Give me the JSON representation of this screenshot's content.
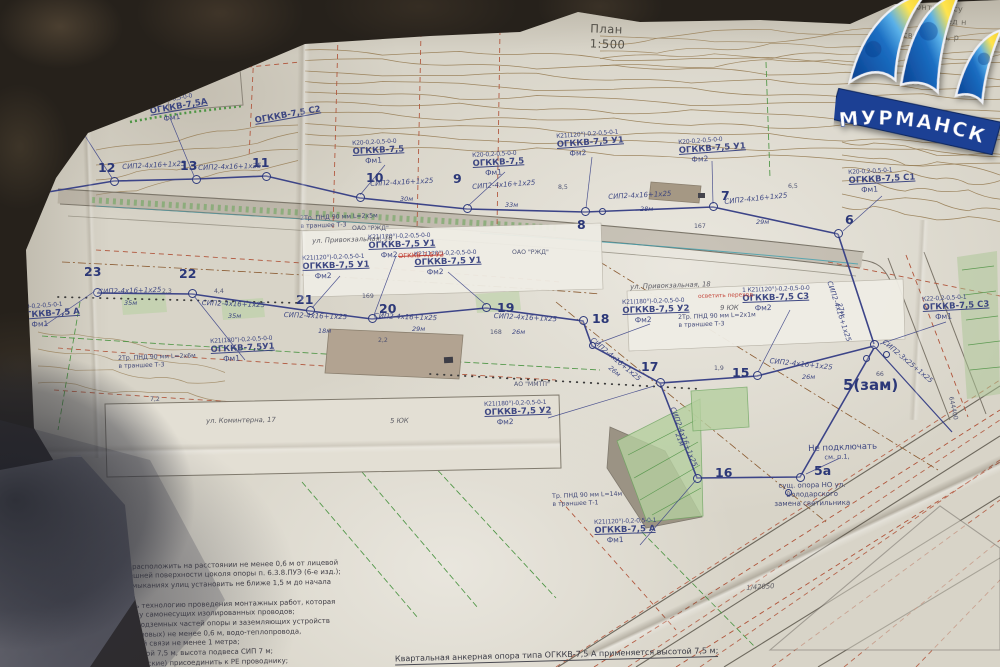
{
  "meta": {
    "title": "План",
    "scale": "1:500"
  },
  "logo": {
    "city": "МУРМАНСК"
  },
  "footer": {
    "line1": "Квартальная анкерная опора типа ОГККВ-7,5 А применяется высотой 7,5 м;",
    "line2": "12, 14, 16, 23;"
  },
  "notes": [
    "1.Опоры наружного освещения расположить на расстоянии не менее 0,6 м от лицевой грани бортового камня до внешней поверхности цоколя опоры п. 6.3.8.ПУЭ (6-е изд.);",
    "2.Опоры на пересечениях и примыканиях улиц установить не ближе 1,5 м до начала закругления тротуаров;",
    "3.При монтаже строго соблюдать технологию проведения монтажных работ, которая обеспечит правильную подвеску самонесущих изолированных проводов;",
    "4.Расстояние по горизонтали от подземных частей опоры и заземляющих устройств опор до подземных кабелей (силовых) не менее 0,6 м, водо-теплопровода, канализационных труб и кабелей связи не менее 1 метра;",
    "5.Опора ОГККВ применяется высотой 7,5 м, высота подвеса СИП 7 м;",
    "6.Опоры и конструкции (металлические) присоединить к РЕ проводнику;"
  ],
  "plan": {
    "poles": [
      {
        "n": "12",
        "cx": 114,
        "cy": 181,
        "nx": 98,
        "ny": 160
      },
      {
        "n": "13",
        "cx": 196,
        "cy": 179,
        "nx": 180,
        "ny": 158
      },
      {
        "n": "11",
        "cx": 266,
        "cy": 176,
        "nx": 252,
        "ny": 155
      },
      {
        "n": "10",
        "cx": 360,
        "cy": 197,
        "nx": 366,
        "ny": 170
      },
      {
        "n": "9",
        "cx": 467,
        "cy": 208,
        "nx": 453,
        "ny": 171
      },
      {
        "n": "8",
        "cx": 585,
        "cy": 211,
        "nx": 577,
        "ny": 217
      },
      {
        "n": "7",
        "cx": 713,
        "cy": 206,
        "nx": 721,
        "ny": 188
      },
      {
        "n": "6",
        "cx": 838,
        "cy": 233,
        "nx": 845,
        "ny": 212
      },
      {
        "n": "23",
        "cx": 97,
        "cy": 292,
        "nx": 84,
        "ny": 264
      },
      {
        "n": "22",
        "cx": 192,
        "cy": 293,
        "nx": 179,
        "ny": 266
      },
      {
        "n": "21",
        "cx": 310,
        "cy": 310,
        "nx": 296,
        "ny": 292
      },
      {
        "n": "20",
        "cx": 372,
        "cy": 318,
        "nx": 379,
        "ny": 301
      },
      {
        "n": "19",
        "cx": 486,
        "cy": 307,
        "nx": 497,
        "ny": 300
      },
      {
        "n": "18",
        "cx": 583,
        "cy": 320,
        "nx": 592,
        "ny": 311
      },
      {
        "n": "17",
        "cx": 660,
        "cy": 382,
        "nx": 641,
        "ny": 359
      },
      {
        "n": "15",
        "cx": 757,
        "cy": 375,
        "nx": 732,
        "ny": 365
      },
      {
        "n": "16",
        "cx": 697,
        "cy": 478,
        "nx": 715,
        "ny": 465
      },
      {
        "n": "5а",
        "cx": 800,
        "cy": 477,
        "nx": 814,
        "ny": 463
      },
      {
        "n": "5(зам)",
        "cx": 874,
        "cy": 344,
        "nx": 843,
        "ny": 376,
        "big": true
      }
    ],
    "extra_rings": [
      [
        602,
        211
      ],
      [
        592,
        345
      ],
      [
        886,
        354
      ],
      [
        866,
        358
      ],
      [
        788,
        492
      ]
    ],
    "labels": [
      {
        "k": "spec",
        "x": 352,
        "y": 140,
        "r": -3,
        "c": "К20-0,2-0,5-0-0",
        "n": "ОГККВ-7,5",
        "p": "Фм1"
      },
      {
        "k": "spec",
        "x": 472,
        "y": 152,
        "r": -3,
        "c": "К20-0,2-0,5-0-0",
        "n": "ОГККВ-7,5",
        "p": "Фм1"
      },
      {
        "k": "spec",
        "x": 556,
        "y": 133,
        "r": -4,
        "c": "К21(120°)-0,2-0,5-0-1",
        "n": "ОГККВ-7,5 У1",
        "p": "Фм2"
      },
      {
        "k": "spec",
        "x": 678,
        "y": 139,
        "r": -4,
        "c": "К20-0,2-0,5-0-0",
        "n": "ОГККВ-7,5 У1",
        "p": "Фм2"
      },
      {
        "k": "spec",
        "x": 848,
        "y": 169,
        "r": -3,
        "c": "К20-0,2-0,5-0-1",
        "n": "ОГККВ-7,5 С1",
        "p": "Фм1"
      },
      {
        "k": "spec",
        "x": 368,
        "y": 234,
        "r": -2,
        "c": "К21(120°)-0,2-0,5-0-0",
        "n": "ОГККВ-7,5 У1",
        "p": "Фм2"
      },
      {
        "k": "spec",
        "x": 302,
        "y": 255,
        "r": -2,
        "c": "К21(120°)-0,2-0,5-0-1",
        "n": "ОГККВ-7,5 У1",
        "p": "Фм2"
      },
      {
        "k": "spec",
        "x": 414,
        "y": 251,
        "r": -2,
        "c": "К21(120°)-0,2-0,5-0-0",
        "n": "ОГККВ-7,5 У1",
        "p": "Фм2"
      },
      {
        "k": "spec",
        "x": 622,
        "y": 299,
        "r": -2,
        "c": "К21(180°)-0,2-0,5-0-0",
        "n": "ОГККВ-7,5 У2",
        "p": "Фм2"
      },
      {
        "k": "spec",
        "x": 742,
        "y": 287,
        "r": -2,
        "c": "1 К21(120°)-0,2-0,5-0-0",
        "n": "ОГККВ-7,5 С3",
        "p": "Фм2"
      },
      {
        "k": "spec",
        "x": 484,
        "y": 401,
        "r": -2,
        "c": "К21(180°)-0,2-0,5-0-1",
        "n": "ОГККВ-7,5 У2",
        "p": "Фм2"
      },
      {
        "k": "spec",
        "x": 594,
        "y": 519,
        "r": -2,
        "c": "К21(120°)-0,2-0,5-0-1",
        "n": "ОГККВ-7,5 А",
        "p": "Фм1"
      },
      {
        "k": "spec",
        "x": 922,
        "y": 296,
        "r": -3,
        "c": "К22-0,2-0,5-0-1",
        "n": "ОГККВ-7,5 С3",
        "p": "Фм1"
      },
      {
        "k": "spec",
        "x": 18,
        "y": 304,
        "r": -4,
        "c": "К20-0,2-0,5-0-1",
        "n": "ОГККВ-7,5 А",
        "p": "Фм1"
      },
      {
        "k": "spec",
        "x": 210,
        "y": 338,
        "r": -3,
        "c": "К21(180°)-0,2-0,5-0-0",
        "n": "ОГККВ-7,5У1",
        "p": "Фм1"
      },
      {
        "k": "spec",
        "x": 64,
        "y": 110,
        "r": -9,
        "c": "К20-0,2-0,5-0-1",
        "n": "ОГККВ-7,5А",
        "p": "Фм1"
      },
      {
        "k": "spec",
        "x": 148,
        "y": 100,
        "r": -10,
        "c": "К20-0,2-0,5-0-0",
        "n": "ОГККВ-7,5А",
        "p": "Фм1"
      },
      {
        "k": "spec",
        "x": 254,
        "y": 116,
        "r": -10,
        "c": "",
        "n": "ОГККВ-7,5 С2",
        "p": ""
      },
      {
        "k": "wire",
        "x": 370,
        "y": 180,
        "r": -3,
        "t": "СИП2-4х16+1х25"
      },
      {
        "k": "wire",
        "x": 472,
        "y": 183,
        "r": -4,
        "t": "СИП2-4х16+1х25"
      },
      {
        "k": "wire",
        "x": 608,
        "y": 193,
        "r": -3,
        "t": "СИП2-4х16+1х25"
      },
      {
        "k": "wire",
        "x": 724,
        "y": 198,
        "r": -6,
        "t": "СИП2-4х16+1х25"
      },
      {
        "k": "wire",
        "x": 98,
        "y": 288,
        "r": -2,
        "t": "СИП2-4х16+1х25"
      },
      {
        "k": "wire",
        "x": 202,
        "y": 299,
        "r": 2,
        "t": "СИП2-4х16+1х25"
      },
      {
        "k": "wire",
        "x": 284,
        "y": 311,
        "r": 2,
        "t": "СИП2-4х16+1х25"
      },
      {
        "k": "wire",
        "x": 374,
        "y": 312,
        "r": 2,
        "t": "СИП2-4х16+1х25"
      },
      {
        "k": "wire",
        "x": 494,
        "y": 312,
        "r": 3,
        "t": "СИП2-4х16+1х25"
      },
      {
        "k": "wire",
        "x": 594,
        "y": 336,
        "r": 40,
        "t": "СИП2-4х16+1х25"
      },
      {
        "k": "wire",
        "x": 770,
        "y": 357,
        "r": 6,
        "t": "СИП2-4х16+1х25"
      },
      {
        "k": "wire",
        "x": 676,
        "y": 406,
        "r": 69,
        "t": "СИП2-4х16+1х25"
      },
      {
        "k": "wire",
        "x": 886,
        "y": 338,
        "r": 40,
        "t": "СИП2-3х25+1х25"
      },
      {
        "k": "wire",
        "x": 833,
        "y": 280,
        "r": 72,
        "t": "СИП2-4х16+1х25"
      },
      {
        "k": "wire",
        "x": 122,
        "y": 163,
        "r": -3,
        "t": "СИП2-4х16+1х25"
      },
      {
        "k": "wire",
        "x": 198,
        "y": 164,
        "r": -2,
        "t": "СИП2-4х16+1х25"
      },
      {
        "k": "len",
        "x": 400,
        "y": 195,
        "t": "30м"
      },
      {
        "k": "len",
        "x": 505,
        "y": 201,
        "t": "33м"
      },
      {
        "k": "len",
        "x": 640,
        "y": 205,
        "t": "28м"
      },
      {
        "k": "len",
        "x": 756,
        "y": 218,
        "t": "29м"
      },
      {
        "k": "len",
        "x": 124,
        "y": 299,
        "t": "35м"
      },
      {
        "k": "len",
        "x": 228,
        "y": 312,
        "t": "35м"
      },
      {
        "k": "len",
        "x": 318,
        "y": 327,
        "t": "18м"
      },
      {
        "k": "len",
        "x": 412,
        "y": 325,
        "t": "29м"
      },
      {
        "k": "len",
        "x": 512,
        "y": 328,
        "t": "26м"
      },
      {
        "k": "len",
        "x": 612,
        "y": 364,
        "r": 40,
        "t": "26м"
      },
      {
        "k": "len",
        "x": 802,
        "y": 373,
        "t": "26м"
      },
      {
        "k": "len",
        "x": 681,
        "y": 432,
        "r": 69,
        "t": "21м"
      },
      {
        "k": "len",
        "x": 843,
        "y": 302,
        "r": 72,
        "t": "27м"
      },
      {
        "k": "trench",
        "x": 300,
        "y": 215,
        "r": -2,
        "a": "2Тр. ПНД 90 мм L=2х5м",
        "b": "в траншее Т-3"
      },
      {
        "k": "trench",
        "x": 678,
        "y": 314,
        "r": -2,
        "a": "2Тр. ПНД 90 мм L=2х1м",
        "b": "в траншее Т-3"
      },
      {
        "k": "trench",
        "x": 118,
        "y": 355,
        "r": -2,
        "a": "2Тр. ПНД 90 мм L=2х6м",
        "b": "в траншее Т-3"
      },
      {
        "k": "trench",
        "x": 552,
        "y": 493,
        "r": -2,
        "a": "Тр. ПНД 90 мм L=14м",
        "b": "в траншее Т-1"
      },
      {
        "k": "place",
        "x": 312,
        "y": 237,
        "r": -2,
        "t": "ул. Привокзальная, 16"
      },
      {
        "k": "place",
        "x": 630,
        "y": 283,
        "r": -2,
        "t": "ул. Привокзальная, 18"
      },
      {
        "k": "place",
        "x": 206,
        "y": 417,
        "r": -1,
        "t": "ул. Коминтерна, 17"
      },
      {
        "k": "place",
        "x": 390,
        "y": 417,
        "r": -1,
        "t": "5 ЮК"
      },
      {
        "k": "place",
        "x": 720,
        "y": 304,
        "r": -1,
        "t": "9 ЮК"
      },
      {
        "k": "place",
        "x": 746,
        "y": 584,
        "r": -4,
        "t": "1/42050"
      },
      {
        "k": "tiny",
        "x": 352,
        "y": 225,
        "t": "ОАО \"РЖД\""
      },
      {
        "k": "tiny",
        "x": 512,
        "y": 249,
        "t": "ОАО \"РЖД\""
      },
      {
        "k": "tiny",
        "x": 514,
        "y": 381,
        "t": "АО \"ММТП\""
      },
      {
        "k": "tiny",
        "x": 954,
        "y": 396,
        "r": 78,
        "t": "644400"
      },
      {
        "k": "tiny",
        "x": 362,
        "y": 293,
        "t": "169"
      },
      {
        "k": "tiny",
        "x": 490,
        "y": 329,
        "t": "168"
      },
      {
        "k": "tiny",
        "x": 694,
        "y": 223,
        "t": "167"
      },
      {
        "k": "tiny",
        "x": 876,
        "y": 371,
        "t": "66"
      },
      {
        "k": "tiny",
        "x": 162,
        "y": 288,
        "t": "2,3"
      },
      {
        "k": "tiny",
        "x": 214,
        "y": 288,
        "t": "4,4"
      },
      {
        "k": "tiny",
        "x": 378,
        "y": 337,
        "t": "2,2"
      },
      {
        "k": "tiny",
        "x": 788,
        "y": 183,
        "t": "6,5"
      },
      {
        "k": "tiny",
        "x": 558,
        "y": 184,
        "t": "8,5"
      },
      {
        "k": "tiny",
        "x": 714,
        "y": 365,
        "t": "1,9"
      },
      {
        "k": "tiny",
        "x": 150,
        "y": 396,
        "t": "7,2"
      },
      {
        "k": "red strike",
        "x": 398,
        "y": 252,
        "r": -2,
        "t": "ОГККВ-7,5 У2"
      },
      {
        "k": "red",
        "x": 698,
        "y": 294,
        "r": -2,
        "t": "осветить переход"
      },
      {
        "k": "noc",
        "x": 808,
        "y": 444,
        "r": -2,
        "a": "Не подключать",
        "b": "см. п.1,"
      },
      {
        "k": "exist",
        "x": 774,
        "y": 482,
        "r": -1,
        "a": "сущ. опора НО ул.",
        "b": "Володарского",
        "c": "замена светильника"
      },
      {
        "k": "frag",
        "x": 910,
        "y": 2,
        "r": 3,
        "t": "монтаж осу"
      },
      {
        "k": "frag",
        "x": 930,
        "y": 16,
        "r": 3,
        "t": "Перед н"
      },
      {
        "k": "frag",
        "x": 898,
        "y": 30,
        "r": 3,
        "t": "освещения, р"
      }
    ]
  }
}
